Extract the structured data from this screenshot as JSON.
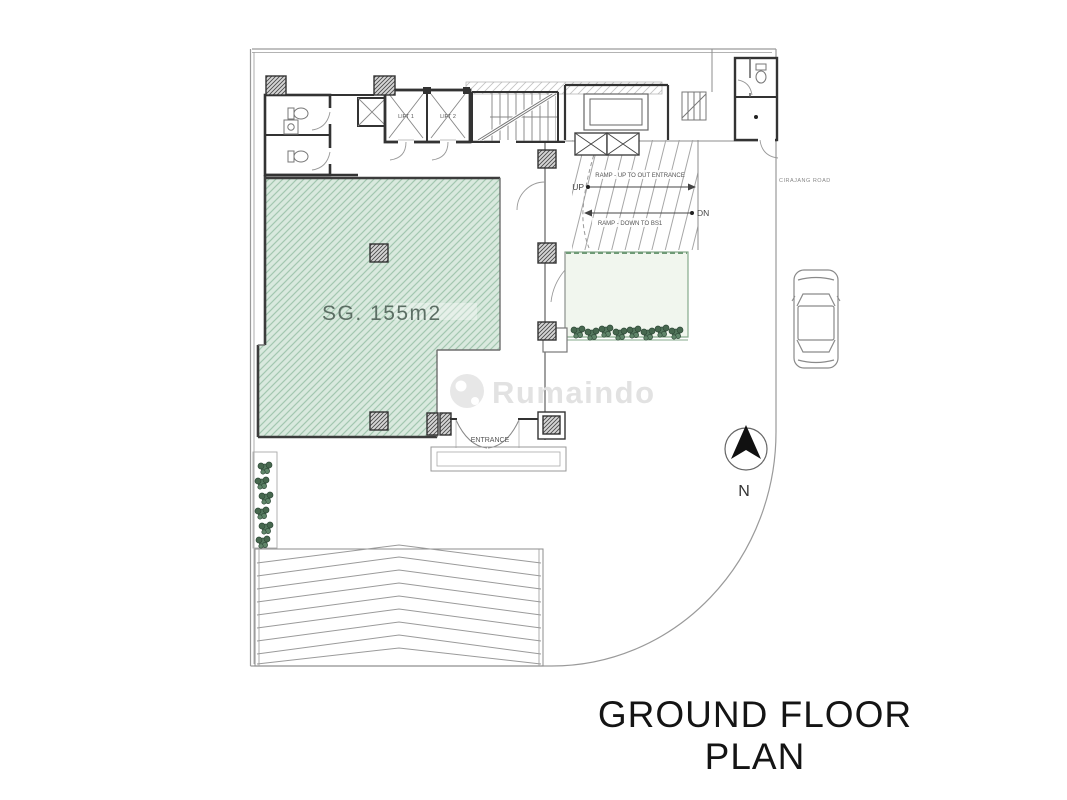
{
  "page": {
    "title": "GROUND FLOOR PLAN",
    "watermark": "Rumaindo"
  },
  "plan": {
    "hall_area_label": "SG. 155m2",
    "entrance_label": "ENTRANCE",
    "lift_labels": {
      "lift1": "LIFT 1",
      "lift2": "LIFT 2"
    },
    "ramp": {
      "up_short": "UP",
      "down_short": "DN",
      "up_label": "RAMP - UP TO OUT ENTRANCE",
      "down_label": "RAMP - DOWN TO BS1"
    },
    "road_label": "CIRAJANG ROAD",
    "compass_label": "N"
  },
  "colors": {
    "hall_fill": "#d9e9de",
    "hall_hatch": "#a3c7b0",
    "garden_fill": "#f1f6ee",
    "garden_line": "#86a98b",
    "wall": "#333333",
    "drawing_line": "#8c8c8c",
    "watermark": "#e3e3e3",
    "title": "#141414"
  }
}
